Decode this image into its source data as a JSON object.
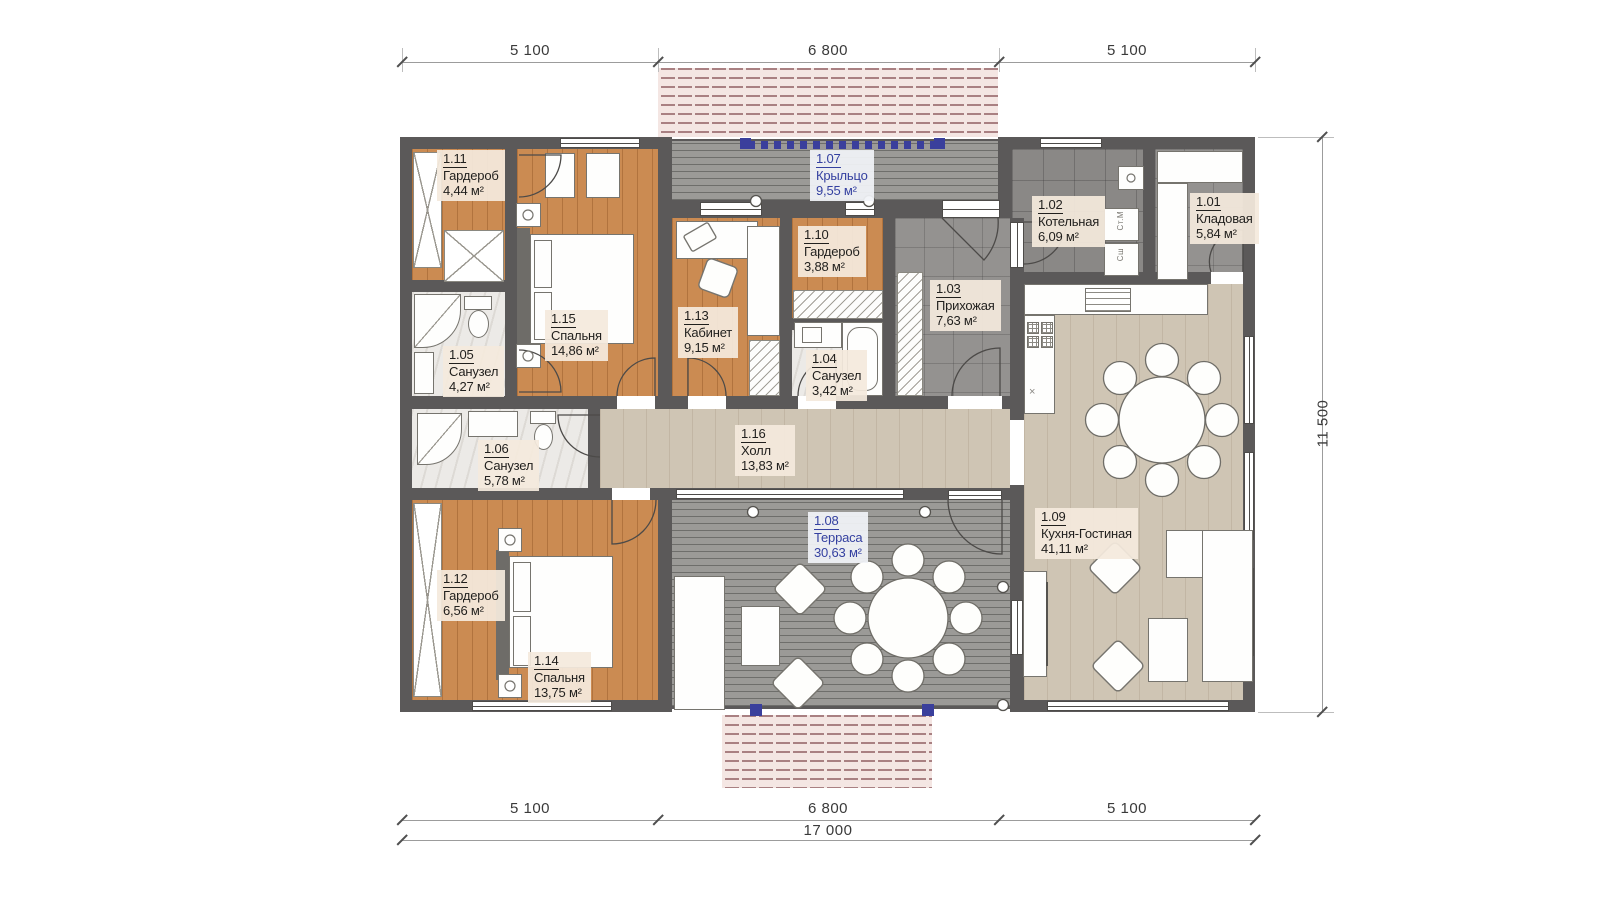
{
  "plan": {
    "rooms": [
      {
        "id": "1.11",
        "name": "Гардероб",
        "area": "4,44 м²"
      },
      {
        "id": "1.15",
        "name": "Спальня",
        "area": "14,86 м²"
      },
      {
        "id": "1.13",
        "name": "Кабинет",
        "area": "9,15 м²"
      },
      {
        "id": "1.10",
        "name": "Гардероб",
        "area": "3,88 м²"
      },
      {
        "id": "1.07",
        "name": "Крыльцо",
        "area": "9,55 м²"
      },
      {
        "id": "1.03",
        "name": "Прихожая",
        "area": "7,63 м²"
      },
      {
        "id": "1.02",
        "name": "Котельная",
        "area": "6,09 м²"
      },
      {
        "id": "1.01",
        "name": "Кладовая",
        "area": "5,84 м²"
      },
      {
        "id": "1.05",
        "name": "Санузел",
        "area": "4,27 м²"
      },
      {
        "id": "1.04",
        "name": "Санузел",
        "area": "3,42 м²"
      },
      {
        "id": "1.06",
        "name": "Санузел",
        "area": "5,78 м²"
      },
      {
        "id": "1.16",
        "name": "Холл",
        "area": "13,83 м²"
      },
      {
        "id": "1.12",
        "name": "Гардероб",
        "area": "6,56 м²"
      },
      {
        "id": "1.14",
        "name": "Спальня",
        "area": "13,75 м²"
      },
      {
        "id": "1.08",
        "name": "Терраса",
        "area": "30,63 м²"
      },
      {
        "id": "1.09",
        "name": "Кухня-Гостиная",
        "area": "41,11 м²"
      }
    ],
    "dims": {
      "top": [
        "5 100",
        "6 800",
        "5 100"
      ],
      "bottom": [
        "5 100",
        "6 800",
        "5 100"
      ],
      "total": "17 000",
      "height": "11 500"
    },
    "appliances": {
      "washer": "Ст.М",
      "dryer": "Сш",
      "drain": "×"
    },
    "colors": {
      "wall": "#5b5959",
      "wood": "#cb8b52",
      "light_wood": "#cfc5b4",
      "deck": "#9b9a97",
      "tile": "#949290",
      "marble": "#eceae7",
      "accent_blue": "#3440a0",
      "roof_hatch_dash": "#a98082",
      "railing_blue": "#3a3f9c"
    }
  }
}
